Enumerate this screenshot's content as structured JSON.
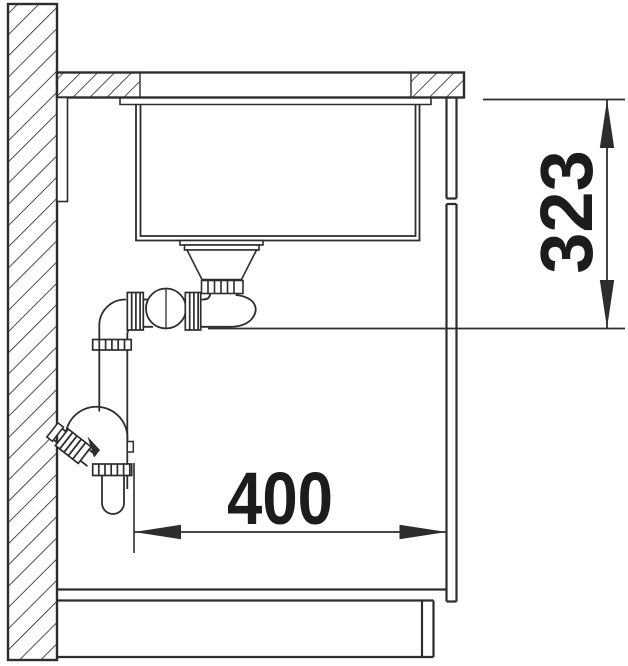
{
  "page": {
    "background_color": "#ffffff",
    "line_color": "#2d2d2d",
    "text_color": "#1c1c1c"
  },
  "diagram": {
    "type": "sink-installation-cross-section",
    "dimensions": [
      {
        "id": "drain-height",
        "label": "323",
        "orientation": "vertical"
      },
      {
        "id": "clearance-width",
        "label": "400",
        "orientation": "horizontal"
      }
    ]
  }
}
